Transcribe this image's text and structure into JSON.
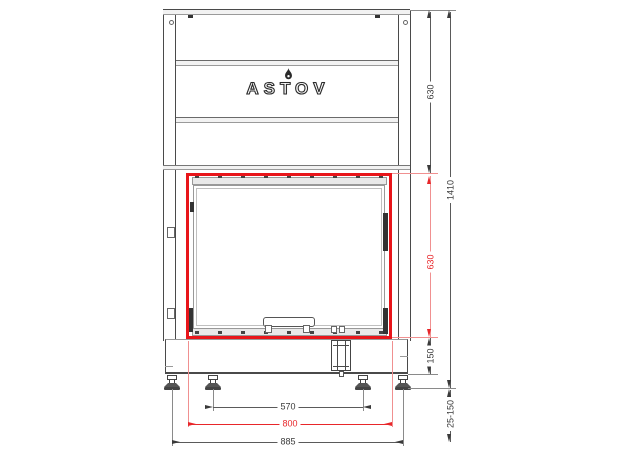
{
  "drawing": {
    "brand": "ASTOV",
    "highlight_color": "#e8151a",
    "dimension_red": "#e8262a",
    "line_color": "#4a4a4a",
    "dimensions": {
      "header_height": "630",
      "opening_height": "630",
      "total_height": "1410",
      "base_height": "150",
      "leg_adjust_range": "25-150",
      "leg_spacing": "570",
      "opening_width": "800",
      "overall_width": "885"
    }
  }
}
